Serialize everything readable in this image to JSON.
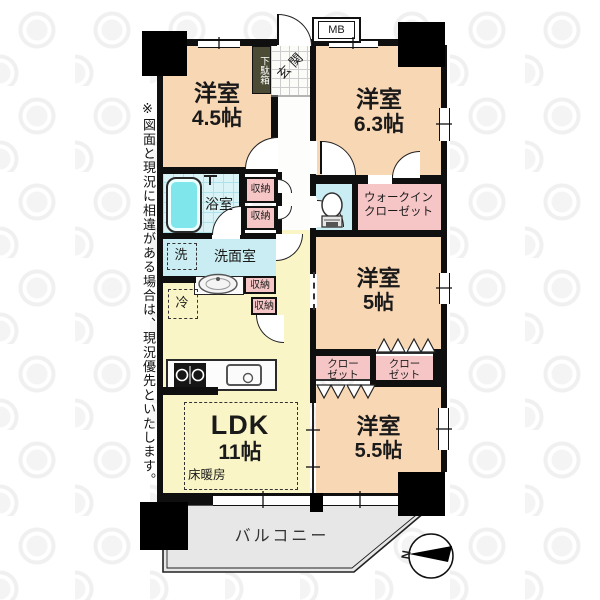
{
  "disclaimer": "※図面と現況に相違がある場合は、現況優先といたします。",
  "labels": {
    "mb": "MB",
    "entrance": "玄関",
    "shoe_box": "下駄箱",
    "bathroom": "浴室",
    "washroom": "洗面室",
    "washer": "洗",
    "fridge": "冷",
    "storage": "収納",
    "floor_heating": "床暖房",
    "balcony": "バルコニー",
    "compass_north": "N",
    "wic_line1": "ウォークイン",
    "wic_line2": "クローゼット",
    "closet_line1": "クロー",
    "closet_line2": "ゼット"
  },
  "rooms": {
    "west1": {
      "name": "洋室",
      "size": "4.5帖"
    },
    "west2": {
      "name": "洋室",
      "size": "6.3帖"
    },
    "west3": {
      "name": "洋室",
      "size": "5帖"
    },
    "west4": {
      "name": "洋室",
      "size": "5.5帖"
    },
    "ldk": {
      "name": "LDK",
      "size": "11帖"
    }
  },
  "colors": {
    "room_peach": "#F8D7B4",
    "closet_pink": "#F6C6C6",
    "water_cyan": "#C9EDF2",
    "ldk_yellow": "#FAF5C6",
    "balcony_gray": "#E7E7E7",
    "tub_cyan": "#7FE7EC",
    "wall_black": "#0F0F0F",
    "shoebox_olive": "#4C4C36"
  }
}
